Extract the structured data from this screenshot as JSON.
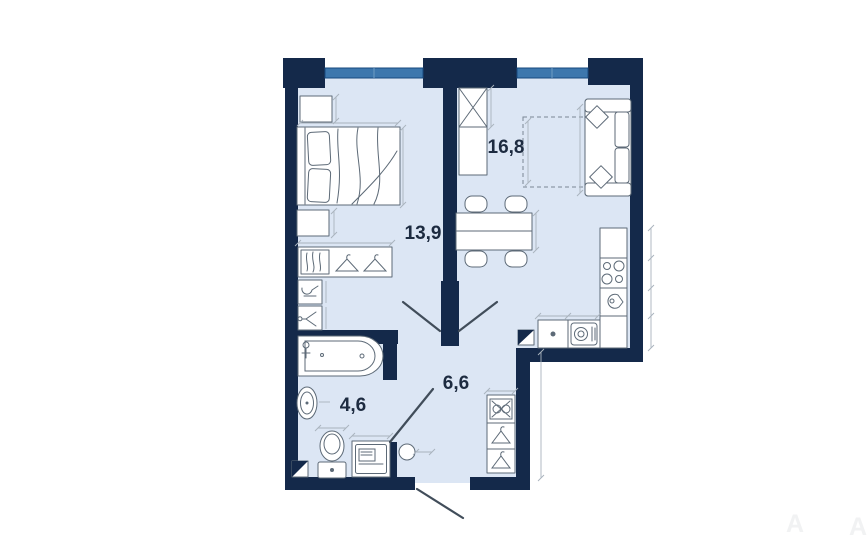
{
  "page": {
    "background": "#ffffff",
    "type": "apartment floor plan drawing"
  },
  "rooms": [
    {
      "name": "bedroom",
      "area_label": "13,9"
    },
    {
      "name": "living-room-kitchen",
      "area_label": "16,8"
    },
    {
      "name": "bathroom",
      "area_label": "4,6"
    },
    {
      "name": "hallway",
      "area_label": "6,6"
    }
  ],
  "watermark": {
    "letter_1": "A",
    "letter_2": "A"
  },
  "colors": {
    "wall": "#14294a",
    "floor": "#dce6f4",
    "window": "#3d77ad",
    "furniture_stroke": "#5d6a77",
    "dimension_line": "#a9b3bd",
    "room_label": "#1d2b40",
    "door_swing": "#414d5a"
  },
  "icons": [
    "double-bed",
    "pillow",
    "nightstand",
    "wardrobe-clothes",
    "clothes-hanger",
    "shelf-towels",
    "tall-cabinet",
    "sofa",
    "sofa-pillow",
    "dining-table",
    "chair",
    "kitchen-counter",
    "stove-burners",
    "kitchen-sink",
    "washing-machine",
    "bathtub",
    "faucet",
    "pedestal-sink",
    "toilet",
    "vent-shaft",
    "hall-wardrobe",
    "pouf",
    "door-swing",
    "window",
    "dashed-bed-outline"
  ]
}
